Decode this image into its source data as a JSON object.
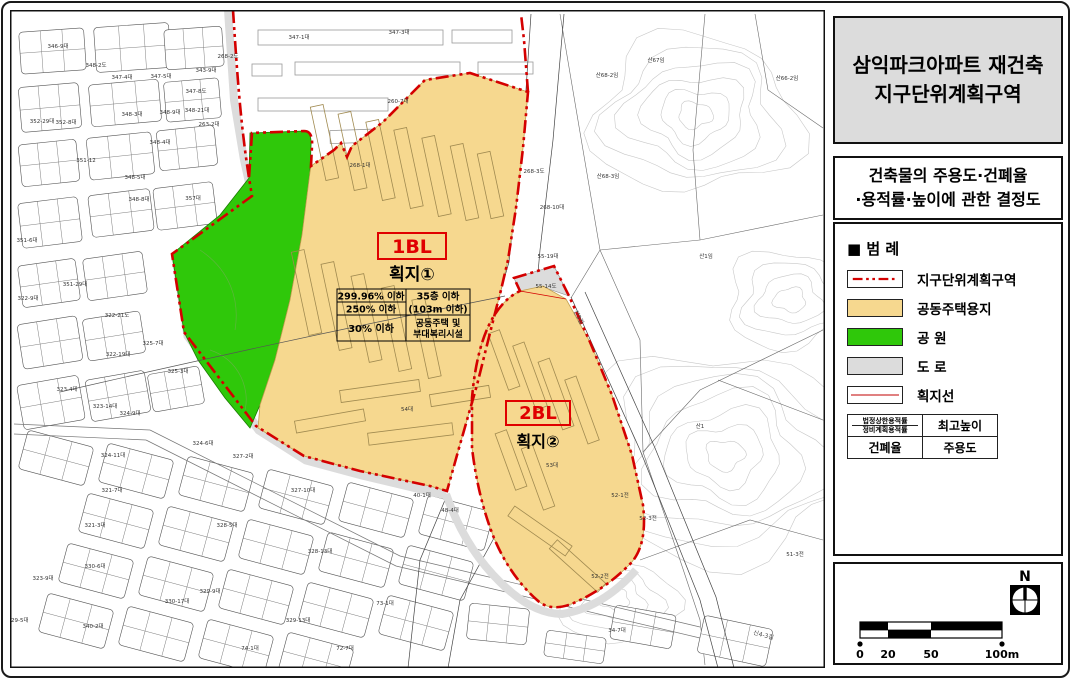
{
  "title_box": {
    "line1": "삼익파크아파트 재건축",
    "line2": "지구단위계획구역"
  },
  "decision_box": {
    "line1": "건축물의 주용도·건폐율",
    "line2": "·용적률·높이에 관한 결정도"
  },
  "legend": {
    "heading": "■ 범  례",
    "items": [
      {
        "name": "district-boundary",
        "label": "지구단위계획구역"
      },
      {
        "name": "residential-land",
        "label": "공동주택용지"
      },
      {
        "name": "park",
        "label": "공  원"
      },
      {
        "name": "road",
        "label": "도  로"
      },
      {
        "name": "parcel-line",
        "label": "획지선"
      }
    ],
    "table": {
      "tl1": "법정상한용적률",
      "tl2": "정비계획용적률",
      "tr": "최고높이",
      "bl": "건폐율",
      "br": "주용도"
    }
  },
  "scale_bar": {
    "labels": [
      "0",
      "20",
      "50",
      "100m"
    ]
  },
  "north": {
    "label": "N"
  },
  "colors": {
    "boundary_red": "#D40000",
    "residential": "#F6D88F",
    "park": "#2FC80A",
    "road_gray": "#DCDCDC",
    "title_bg": "#DCDCDC"
  },
  "map": {
    "block1": {
      "code": "1BL",
      "parcel": "획지①",
      "table": {
        "far_upper": "299.96% 이하",
        "far_lower": "250% 이하",
        "bcr": "30% 이하",
        "height1": "35층 이하",
        "height2": "(103m 이하)",
        "use1": "공동주택 및",
        "use2": "부대복리시설"
      }
    },
    "block2": {
      "code": "2BL",
      "parcel": "획지②"
    },
    "road_labels": [
      {
        "t": "신3길",
        "x": 577,
        "y": 318,
        "r": 63
      },
      {
        "t": "신4-3길",
        "x": 763,
        "y": 637,
        "r": 15
      }
    ],
    "lot_labels": [
      {
        "t": "347-1대",
        "x": 299,
        "y": 39
      },
      {
        "t": "347-3대",
        "x": 399,
        "y": 34
      },
      {
        "t": "346-9대",
        "x": 58,
        "y": 48
      },
      {
        "t": "348-2도",
        "x": 96,
        "y": 67
      },
      {
        "t": "347-4대",
        "x": 122,
        "y": 79
      },
      {
        "t": "347-5대",
        "x": 161,
        "y": 78
      },
      {
        "t": "343-9대",
        "x": 206,
        "y": 72
      },
      {
        "t": "268-2도",
        "x": 228,
        "y": 58
      },
      {
        "t": "347-8도",
        "x": 196,
        "y": 93
      },
      {
        "t": "348-3대",
        "x": 132,
        "y": 116
      },
      {
        "t": "348-9대",
        "x": 170,
        "y": 114
      },
      {
        "t": "348-21대",
        "x": 197,
        "y": 112
      },
      {
        "t": "263-2대",
        "x": 209,
        "y": 126
      },
      {
        "t": "348-4대",
        "x": 160,
        "y": 144
      },
      {
        "t": "352-29대",
        "x": 42,
        "y": 123
      },
      {
        "t": "352-8대",
        "x": 66,
        "y": 124
      },
      {
        "t": "351-12",
        "x": 86,
        "y": 162
      },
      {
        "t": "348-5대",
        "x": 135,
        "y": 179
      },
      {
        "t": "357대",
        "x": 193,
        "y": 200
      },
      {
        "t": "348-8대",
        "x": 139,
        "y": 201
      },
      {
        "t": "260-7대",
        "x": 398,
        "y": 103
      },
      {
        "t": "268-1대",
        "x": 360,
        "y": 167
      },
      {
        "t": "268-3도",
        "x": 534,
        "y": 173
      },
      {
        "t": "268-10대",
        "x": 552,
        "y": 209
      },
      {
        "t": "55-19대",
        "x": 548,
        "y": 258
      },
      {
        "t": "55-14도",
        "x": 546,
        "y": 288
      },
      {
        "t": "산68-2임",
        "x": 607,
        "y": 77
      },
      {
        "t": "산67임",
        "x": 656,
        "y": 62
      },
      {
        "t": "산66-2임",
        "x": 787,
        "y": 80
      },
      {
        "t": "산68-3임",
        "x": 608,
        "y": 178
      },
      {
        "t": "산1임",
        "x": 706,
        "y": 258
      },
      {
        "t": "산1",
        "x": 700,
        "y": 428
      },
      {
        "t": "53대",
        "x": 552,
        "y": 467
      },
      {
        "t": "54대",
        "x": 407,
        "y": 411
      },
      {
        "t": "52-1전",
        "x": 620,
        "y": 497
      },
      {
        "t": "51-3전",
        "x": 795,
        "y": 556
      },
      {
        "t": "52-2전",
        "x": 600,
        "y": 578
      },
      {
        "t": "52-3전",
        "x": 648,
        "y": 520
      },
      {
        "t": "34-7대",
        "x": 617,
        "y": 632
      },
      {
        "t": "351-6대",
        "x": 27,
        "y": 242
      },
      {
        "t": "351-29대",
        "x": 75,
        "y": 286
      },
      {
        "t": "322-9대",
        "x": 28,
        "y": 300
      },
      {
        "t": "322-21도",
        "x": 117,
        "y": 317
      },
      {
        "t": "325-7대",
        "x": 153,
        "y": 345
      },
      {
        "t": "322-19대",
        "x": 118,
        "y": 356
      },
      {
        "t": "325-3대",
        "x": 178,
        "y": 373
      },
      {
        "t": "323-4대",
        "x": 67,
        "y": 391
      },
      {
        "t": "323-14대",
        "x": 105,
        "y": 408
      },
      {
        "t": "324-9대",
        "x": 130,
        "y": 415
      },
      {
        "t": "324-6대",
        "x": 203,
        "y": 445
      },
      {
        "t": "324-11대",
        "x": 113,
        "y": 457
      },
      {
        "t": "327-2대",
        "x": 243,
        "y": 458
      },
      {
        "t": "321-7대",
        "x": 112,
        "y": 492
      },
      {
        "t": "327-10대",
        "x": 303,
        "y": 492
      },
      {
        "t": "321-3대",
        "x": 95,
        "y": 527
      },
      {
        "t": "328-5대",
        "x": 227,
        "y": 527
      },
      {
        "t": "328-13대",
        "x": 320,
        "y": 553
      },
      {
        "t": "330-6대",
        "x": 95,
        "y": 568
      },
      {
        "t": "323-9대",
        "x": 43,
        "y": 580
      },
      {
        "t": "329-9대",
        "x": 210,
        "y": 593
      },
      {
        "t": "330-17대",
        "x": 177,
        "y": 603
      },
      {
        "t": "329-13대",
        "x": 298,
        "y": 622
      },
      {
        "t": "340-2대",
        "x": 93,
        "y": 628
      },
      {
        "t": "329-5대",
        "x": 18,
        "y": 622
      },
      {
        "t": "72-7대",
        "x": 345,
        "y": 650
      },
      {
        "t": "73-1대",
        "x": 385,
        "y": 605
      },
      {
        "t": "74-1대",
        "x": 250,
        "y": 650
      },
      {
        "t": "40-1대",
        "x": 422,
        "y": 497
      },
      {
        "t": "48-4대",
        "x": 450,
        "y": 512
      }
    ]
  }
}
